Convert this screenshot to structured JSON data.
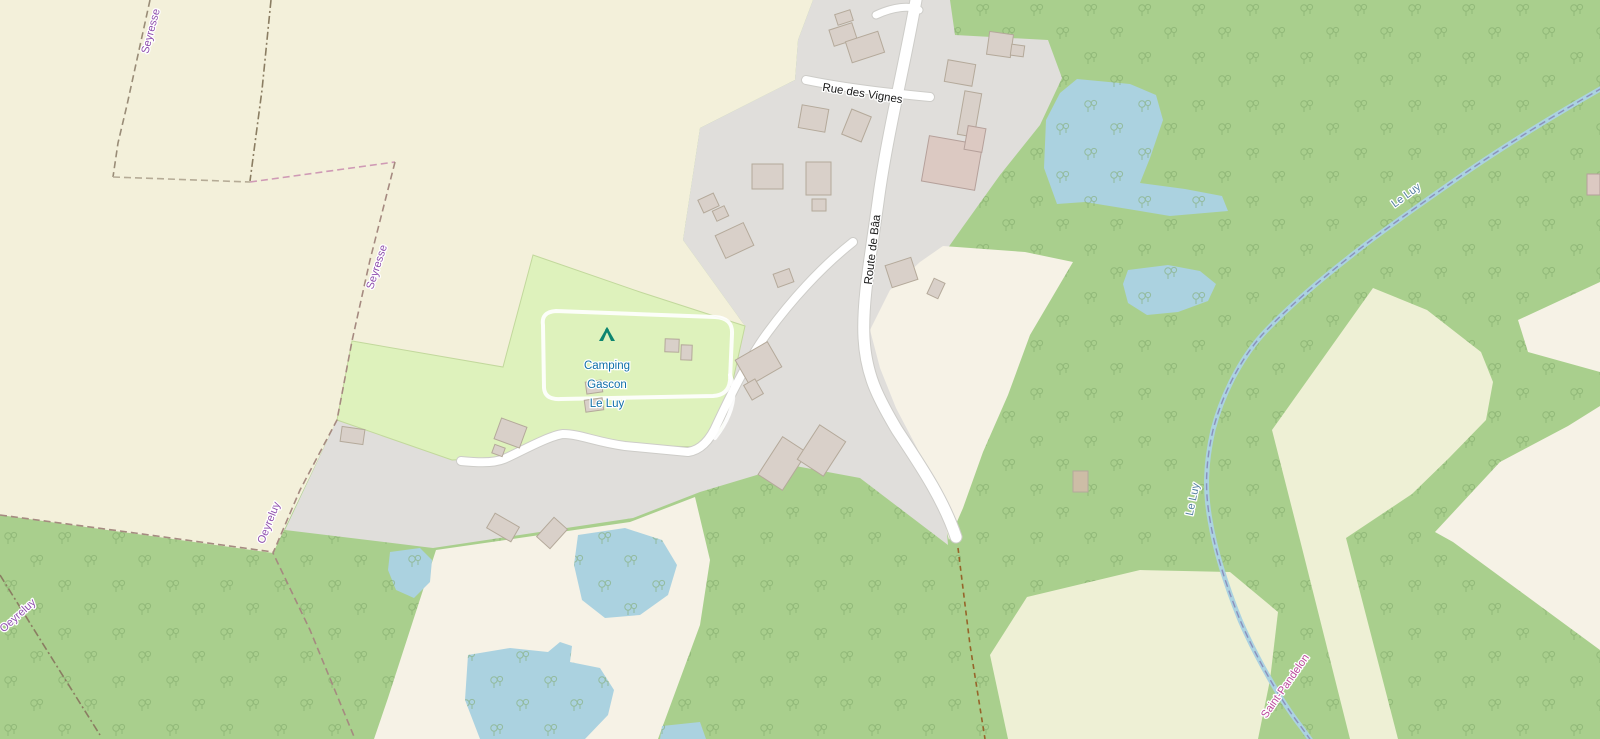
{
  "map": {
    "width": 1600,
    "height": 739,
    "palette": {
      "forest": "#a9cf8d",
      "tree": "#7ea767",
      "farmland": "#f3f0da",
      "residential": "#e0dedb",
      "grass_camp": "#def2bc",
      "camp_border": "#c2d89c",
      "cream": "#f6f2e6",
      "field": "#eef0d5",
      "water": "#abd2e0",
      "road": "#ffffff",
      "road_casing": "#cdccc8",
      "building": "#d9d0c9",
      "building_stroke": "#b4a99a",
      "building_pink": "#dcc9c2",
      "building_pink_stroke": "#b5a09a",
      "building_tan": "#cdbda6",
      "boundary_olive": "#998c77",
      "boundary_grey": "#b5ab96",
      "boundary_pink": "#cf9ab5",
      "boundary_brown": "#a58a80",
      "boundary_dark": "#8a7d62",
      "river_boundary": "#8a90bd",
      "track": "#96642a",
      "admin_label": "#8f4fae",
      "admin_label2": "#bb4a9b",
      "water_label": "#5580a0",
      "road_label": "#1a1a1a",
      "camp_label": "#0f6fa8",
      "tent": "#0d8570",
      "halo": "#ffffff"
    },
    "regions": [
      {
        "name": "farmland-northwest",
        "fill": "farmland",
        "points": "0,0 813,0 798,40 795,80 700,128 683,240 745,326 640,292 533,255 503,367 352,341 337,420 273,553 0,515"
      },
      {
        "name": "residential-area",
        "fill": "residential",
        "points": "813,0 950,0 955,35 1048,40 1062,78 1040,125 1000,175 962,228 938,262 930,315 948,545 860,478 790,465 700,492 633,518 433,548 285,530 337,420 452,460 500,458 560,432 620,445 703,447 722,430 745,326 683,240 700,128 795,80 798,40"
      },
      {
        "name": "campsite-grass",
        "fill": "grass_camp",
        "stroke": "camp_border",
        "points": "533,255 640,292 745,326 722,430 703,447 620,445 560,432 500,458 452,460 337,420 352,341 503,367"
      },
      {
        "name": "clearing-center",
        "fill": "cream",
        "points": "943,246 1025,252 1073,262 1030,335 1008,395 983,452 963,508 949,540 938,498 917,448 896,408 880,368 870,330 890,290 920,262"
      },
      {
        "name": "clearing-southwest",
        "fill": "cream",
        "points": "436,550 630,522 695,497 710,560 700,625 658,739 374,739 388,698"
      },
      {
        "name": "clearing-southeast",
        "fill": "cream",
        "points": "1435,532 1500,462 1568,426 1600,406 1600,650 1453,542"
      },
      {
        "name": "clearing-east-wedge",
        "fill": "cream",
        "points": "1518,320 1600,282 1600,372 1528,352"
      },
      {
        "name": "field-south",
        "fill": "field",
        "points": "1027,597 1140,570 1230,572 1278,612 1270,680 1258,739 1008,739 990,655"
      },
      {
        "name": "field-east",
        "fill": "field",
        "points": "1272,430 1373,288 1427,310 1481,352 1493,382 1486,420 1449,458 1412,494 1346,538 1398,739 1350,739 1300,540"
      }
    ],
    "ponds": [
      {
        "name": "pond-north",
        "points": "1077,79 1130,84 1156,95 1163,120 1150,158 1140,183 1185,189 1222,196 1228,211 1170,216 1128,209 1085,202 1057,204 1044,168 1046,120 1060,93"
      },
      {
        "name": "pond-small",
        "points": "1128,270 1168,265 1200,271 1216,284 1208,301 1178,312 1147,315 1128,303 1123,284"
      },
      {
        "name": "pond-west",
        "points": "390,552 420,548 432,560 430,582 414,598 396,590 388,570"
      },
      {
        "name": "pond-mid",
        "points": "578,535 625,528 662,540 677,565 668,595 640,615 605,618 582,600 574,565"
      },
      {
        "name": "pond-southwest",
        "points": "468,655 510,648 548,652 560,642 572,646 570,662 600,668 614,690 608,715 585,739 480,739 465,700"
      },
      {
        "name": "pond-bottom-edge",
        "points": "662,726 700,722 706,739 660,739"
      }
    ],
    "river": {
      "name": "le-luy-river",
      "d": "M1602,88 C1560,112 1500,148 1448,185 C1405,215 1368,242 1352,255 C1320,280 1285,310 1262,335 C1240,360 1222,395 1213,430 C1205,465 1205,492 1210,520 C1216,556 1228,590 1240,620 C1255,655 1280,700 1302,728 L1312,742",
      "width": 5
    },
    "roads": [
      {
        "name": "road-route-de-baa",
        "d": "M917,-6 C908,50 888,130 879,195 C871,255 862,300 864,338 C866,375 878,398 897,430 C918,462 943,498 956,537",
        "width": 11
      },
      {
        "name": "road-rue-des-vignes",
        "d": "M806,80 C845,88 888,93 930,97",
        "width": 8
      },
      {
        "name": "road-north-spur",
        "d": "M876,15 C893,7 910,5 919,10",
        "width": 7
      },
      {
        "name": "road-camping-access",
        "d": "M853,242 C820,268 790,302 768,332 C750,356 732,392 717,424 C711,438 702,450 688,452 L625,446 C595,442 580,434 563,434 C548,436 520,452 504,459 C492,464 472,462 461,461",
        "width": 8
      }
    ],
    "track_loop": {
      "name": "campsite-track",
      "d": "M543,325 Q541,312 556,311 L715,317 Q733,318 732,334 L730,380 Q729,395 713,396 L561,399 Q545,400 544,388 Z",
      "spur": "M730,375 C739,398 729,420 715,438",
      "width": 4
    },
    "boundaries": [
      {
        "name": "boundary-seyresse-west",
        "color": "boundary_olive",
        "dash": "7 4",
        "d": "M150,0 L127,105 118,143 113,177"
      },
      {
        "name": "boundary-horizontal-left",
        "color": "boundary_grey",
        "dash": "7 4",
        "d": "M113,177 L250,182"
      },
      {
        "name": "boundary-horizontal-pink",
        "color": "boundary_pink",
        "dash": "7 4",
        "d": "M250,182 L395,162"
      },
      {
        "name": "boundary-north",
        "color": "boundary_dark",
        "dash": "8 3 2 3",
        "d": "M271,0 L262,90 250,181"
      },
      {
        "name": "boundary-seyresse-east",
        "color": "boundary_brown",
        "dash": "7 4",
        "d": "M395,162 L370,260 352,341 337,420 300,490 273,553 310,630 355,739"
      },
      {
        "name": "boundary-farmland-south",
        "color": "boundary_brown",
        "dash": "7 4",
        "d": "M0,515 L135,533 273,552"
      },
      {
        "name": "boundary-southwest",
        "color": "boundary_dark",
        "dash": "8 3 2 3",
        "d": "M0,575 L48,652 100,735"
      },
      {
        "name": "footpath-south",
        "color": "track",
        "dash": "5 4",
        "d": "M958,548 L970,645 985,739"
      }
    ],
    "river_boundary_dash": "7 4",
    "buildings": [
      [
        831,
        26,
        24,
        17,
        -18,
        0
      ],
      [
        848,
        36,
        34,
        22,
        -18,
        0
      ],
      [
        836,
        12,
        16,
        11,
        -18,
        0
      ],
      [
        946,
        62,
        28,
        22,
        10,
        0
      ],
      [
        988,
        33,
        24,
        23,
        8,
        0
      ],
      [
        1011,
        45,
        13,
        11,
        8,
        0
      ],
      [
        961,
        92,
        17,
        44,
        10,
        0
      ],
      [
        925,
        140,
        54,
        46,
        10,
        1
      ],
      [
        966,
        127,
        18,
        24,
        10,
        1
      ],
      [
        800,
        107,
        27,
        23,
        10,
        0
      ],
      [
        846,
        112,
        21,
        27,
        22,
        0
      ],
      [
        752,
        164,
        31,
        25,
        0,
        0
      ],
      [
        806,
        162,
        25,
        33,
        0,
        0
      ],
      [
        812,
        199,
        14,
        12,
        0,
        0
      ],
      [
        700,
        196,
        17,
        14,
        -25,
        0
      ],
      [
        714,
        208,
        13,
        11,
        -25,
        0
      ],
      [
        719,
        228,
        31,
        25,
        -25,
        0
      ],
      [
        775,
        271,
        17,
        14,
        -20,
        0
      ],
      [
        888,
        261,
        27,
        23,
        -18,
        0
      ],
      [
        930,
        280,
        12,
        17,
        25,
        0
      ],
      [
        740,
        349,
        37,
        29,
        -30,
        0
      ],
      [
        747,
        381,
        13,
        17,
        -30,
        0
      ],
      [
        665,
        339,
        14,
        13,
        2,
        0
      ],
      [
        681,
        345,
        11,
        15,
        2,
        0
      ],
      [
        586,
        381,
        16,
        12,
        -8,
        0
      ],
      [
        585,
        399,
        18,
        12,
        -8,
        0
      ],
      [
        341,
        428,
        23,
        15,
        8,
        0
      ],
      [
        497,
        422,
        27,
        22,
        20,
        0
      ],
      [
        493,
        446,
        11,
        9,
        20,
        0
      ],
      [
        489,
        519,
        28,
        17,
        30,
        0
      ],
      [
        543,
        520,
        18,
        26,
        42,
        0
      ],
      [
        768,
        441,
        29,
        45,
        33,
        0
      ],
      [
        806,
        430,
        31,
        41,
        33,
        0
      ],
      [
        1073,
        471,
        15,
        21,
        0,
        2
      ],
      [
        1587,
        174,
        13,
        21,
        0,
        1
      ]
    ],
    "labels": [
      {
        "text": "Seyresse",
        "x": 154,
        "y": 32,
        "rot": -75,
        "cls": "admin",
        "size": 11
      },
      {
        "text": "Seyresse",
        "x": 380,
        "y": 268,
        "rot": -72,
        "cls": "admin",
        "size": 11
      },
      {
        "text": "Oeyreluy",
        "x": 272,
        "y": 524,
        "rot": -68,
        "cls": "admin",
        "size": 11
      },
      {
        "text": "Oeyreluy",
        "x": 20,
        "y": 618,
        "rot": -42,
        "cls": "admin",
        "size": 11
      },
      {
        "text": "Saint-Pandelon",
        "x": 1288,
        "y": 688,
        "rot": -55,
        "cls": "admin2",
        "size": 11
      },
      {
        "text": "Le Luy",
        "x": 1408,
        "y": 198,
        "rot": -36,
        "cls": "water",
        "size": 11
      },
      {
        "text": "Le Luy",
        "x": 1196,
        "y": 500,
        "rot": -78,
        "cls": "water",
        "size": 11
      },
      {
        "text": "Rue des Vignes",
        "x": 862,
        "y": 97,
        "rot": 9,
        "cls": "road",
        "size": 11.5
      },
      {
        "text": "Route de Bâa",
        "x": 876,
        "y": 250,
        "rot": -83,
        "cls": "road",
        "size": 11.5
      }
    ],
    "campsite": {
      "label_lines": [
        "Camping",
        "Gascon",
        "Le Luy"
      ],
      "x": 607,
      "y": 369,
      "line_height": 19,
      "size": 11.5,
      "tent_x": 607,
      "tent_y": 341
    }
  }
}
